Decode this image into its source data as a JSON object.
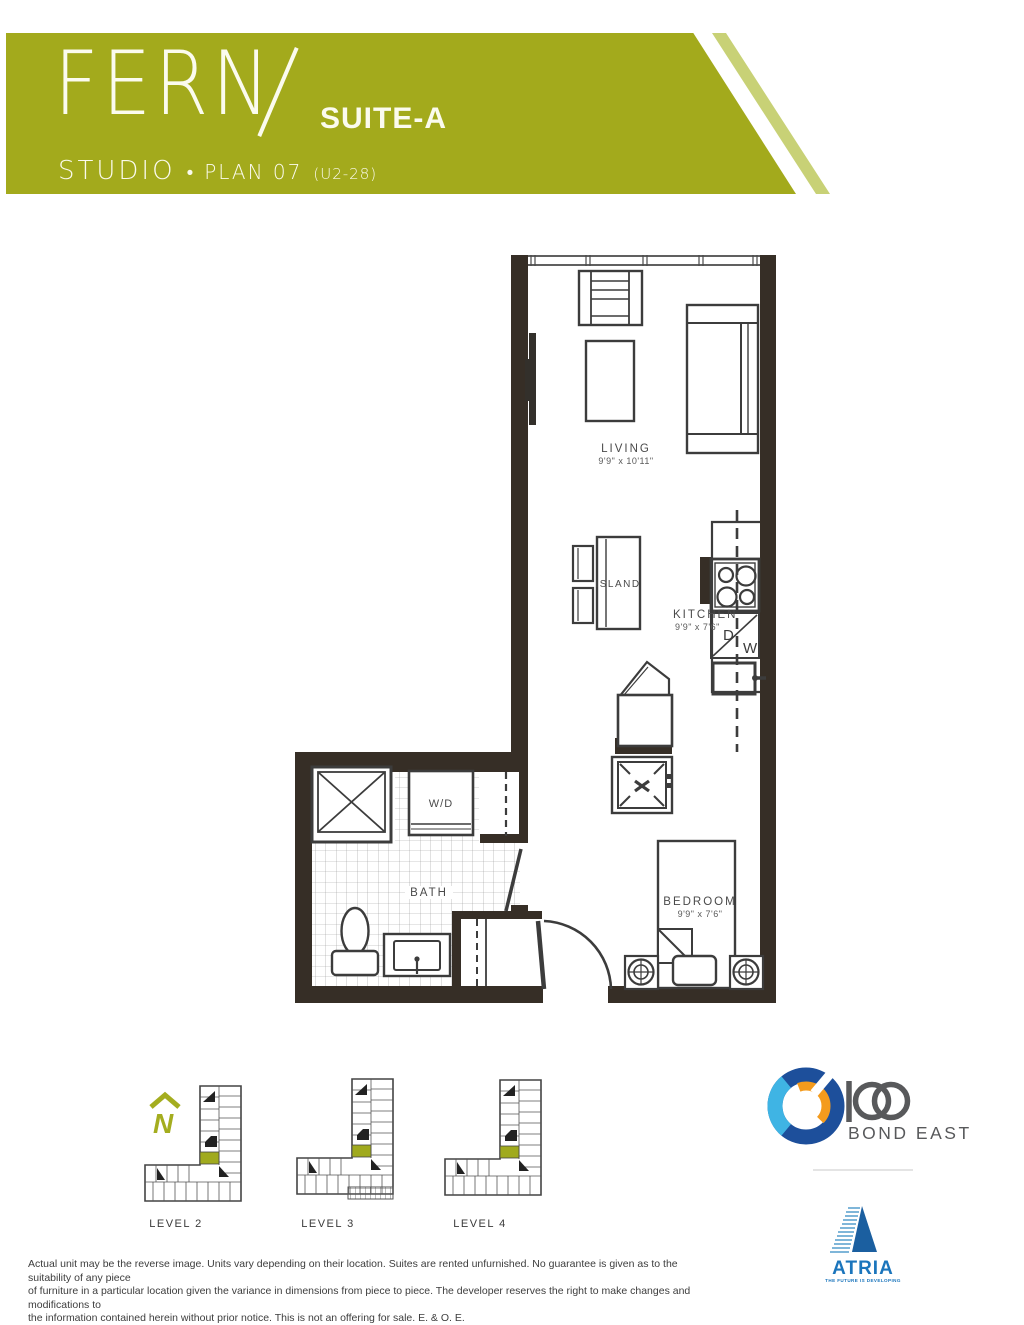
{
  "header": {
    "brand": "FERN",
    "suite": "SUITE-A",
    "type": "STUDIO",
    "bullet": "•",
    "plan": "PLAN 07",
    "unit": "(U2-28)"
  },
  "plan": {
    "living": {
      "name": "LIVING",
      "dims": "9'9\" x 10'11\""
    },
    "kitchen": {
      "name": "KITCHEN",
      "dims": "9'9\" x 7'6\""
    },
    "bedroom": {
      "name": "BEDROOM",
      "dims": "9'9\" x 7'6\""
    },
    "island_label": "ISLAND",
    "bath_label": "BATH",
    "wd_label": "W/D",
    "dw": {
      "d": "D",
      "w": "W"
    }
  },
  "keyplans": {
    "north": "N",
    "levels": [
      "LEVEL 2",
      "LEVEL 3",
      "LEVEL 4"
    ]
  },
  "logos": {
    "bond": {
      "number": "100",
      "name": "BOND EAST"
    },
    "atria": {
      "name": "ATRIA",
      "tagline": "THE FUTURE IS DEVELOPING"
    }
  },
  "disclaimer": [
    "Actual unit may be the reverse image. Units vary depending on their location. Suites are rented unfurnished. No guarantee is given as to the suitability of any piece",
    "of furniture in a particular location given the variance in dimensions from piece to piece. The developer reserves the right to make changes and modifications to",
    "the information contained herein without prior notice. This is not an offering for sale. E. & O. E."
  ],
  "colors": {
    "banner_green": "#a3aa1c",
    "banner_light_green": "#c8d176",
    "wall": "#362e26",
    "plan_line": "#3c3c3c",
    "keyplan_green": "#a0aa1e",
    "bond_blue": "#1d4f9b",
    "bond_cyan": "#3fb4e4",
    "bond_orange": "#f49b1d",
    "logo_gray": "#58595b",
    "atria_blue": "#1b75bc"
  }
}
